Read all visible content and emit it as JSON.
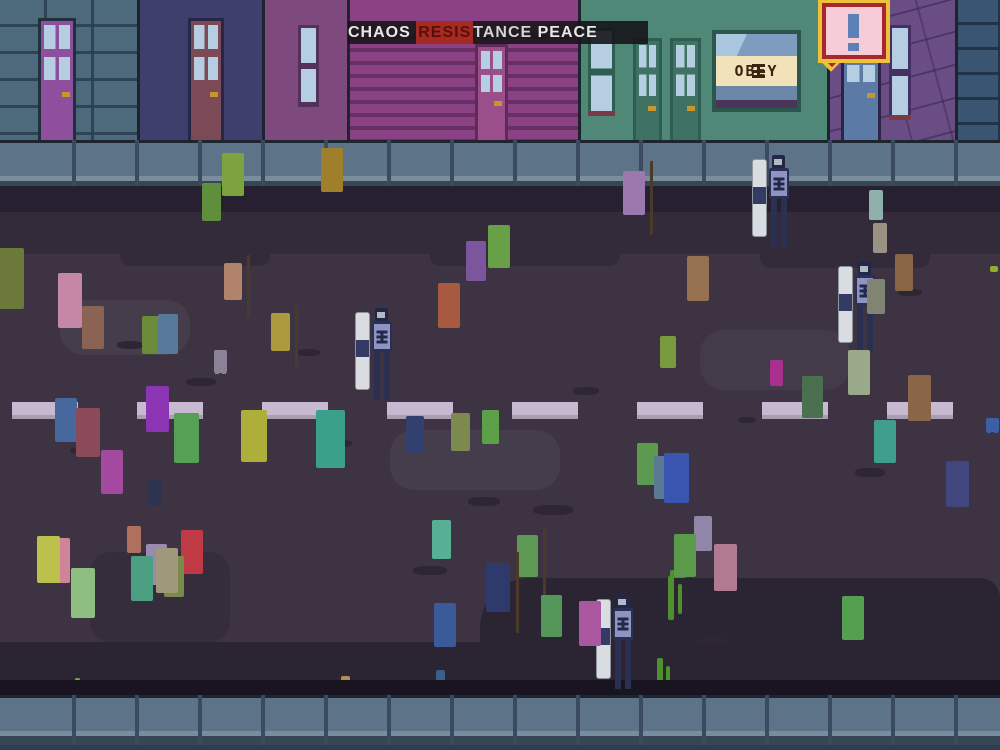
{
  "hud": {
    "meter": {
      "left_label": "CHAOS",
      "center_highlight": "RESIS",
      "center_rest": "TANCE",
      "right_label": "PEACE",
      "highlight_color": "#a62a22",
      "bar_color": "rgba(23,22,26,0.9)"
    }
  },
  "signs": {
    "obey_sign": {
      "text": "OBEY",
      "emblem": "king-emblem",
      "band_color": "#f2e2bb",
      "text_color": "#3a2410"
    },
    "alert_bubble": {
      "icon": "exclamation-icon",
      "fill": "#f6ccd6",
      "border_inner": "#a8262e",
      "border_outer": "#ecc23c",
      "glyph_color": "#5d80b6"
    }
  },
  "palette": {
    "road": "#3d3343",
    "curb_top": "#262031",
    "curb_bottom": "#191520",
    "base_strip": "#2c3e51",
    "sidewalk": "#5d7488",
    "mark": "#2e2634"
  },
  "scene": {
    "buildings": [
      {
        "x": 0,
        "w": 137,
        "wall": "#4d6a7d",
        "pattern": "brick-blue",
        "doors": [
          {
            "x": 38,
            "y": 18,
            "w": 38,
            "color": "#8e509c",
            "frame": "#22303e",
            "paneH": 46,
            "handle": true
          }
        ]
      },
      {
        "x": 137,
        "w": 125,
        "wall": "#3f3f6e",
        "sep": true,
        "doors": [
          {
            "x": 48,
            "y": 18,
            "w": 36,
            "color": "#7c4a56",
            "frame": "#262647",
            "paneH": 46,
            "handle": true
          }
        ]
      },
      {
        "x": 262,
        "w": 85,
        "wall": "#7e4a7e",
        "sep": true,
        "windows": [
          {
            "x": 33,
            "y": 25,
            "w": 21,
            "h": 82,
            "frame": "#54315a",
            "sill": "#54315a",
            "divider": true
          }
        ]
      },
      {
        "x": 347,
        "w": 231,
        "wall": "#8a4285",
        "pattern": "siding",
        "sep": true,
        "doors": [
          {
            "x": 125,
            "y": 44,
            "w": 33,
            "color": "#9a4f8b",
            "frame": "#5e2a5a",
            "paneH": 44,
            "handle": true
          }
        ]
      },
      {
        "x": 578,
        "w": 249,
        "wall": "#4f8877",
        "sep": true,
        "windows": [
          {
            "x": 7,
            "y": 28,
            "w": 27,
            "h": 88,
            "frame": "#2f5d52",
            "sill": "#7a3a45",
            "divider": true
          }
        ],
        "doors": [
          {
            "x": 52,
            "y": 38,
            "w": 29,
            "color": "#3f7263",
            "frame": "#2f5d52",
            "paneH": 52,
            "handle": true
          },
          {
            "x": 89,
            "y": 38,
            "w": 31,
            "color": "#3f7263",
            "frame": "#2f5d52",
            "paneH": 52,
            "handle": true
          }
        ]
      },
      {
        "x": 827,
        "w": 128,
        "wall": "#6b4d86",
        "pattern": "stone",
        "sep": true,
        "doors": [
          {
            "x": 11,
            "y": 34,
            "w": 40,
            "color": "#5b7aa6",
            "frame": "#2c2347",
            "paneH": 40,
            "handle": true
          }
        ],
        "windows": [
          {
            "x": 59,
            "y": 25,
            "w": 22,
            "h": 95,
            "frame": "#453064",
            "sill": "#7a3a45",
            "divider": true
          }
        ]
      },
      {
        "x": 955,
        "w": 45,
        "wall": "#3a5571",
        "pattern": "brick-dark",
        "sep": true
      }
    ],
    "crosswalk": {
      "y": 402,
      "height": 17,
      "dash_width": 66,
      "color": "#c8b9d2",
      "positions": [
        12,
        137,
        262,
        387,
        512,
        637,
        762,
        887
      ]
    },
    "blotches": [
      {
        "x": 0,
        "y": 212,
        "w": 1000,
        "h": 42,
        "c": "#342b3a",
        "r": "0"
      },
      {
        "x": 120,
        "y": 248,
        "w": 150,
        "h": 18,
        "c": "#342b3a",
        "r": "0 0 10px 10px"
      },
      {
        "x": 430,
        "y": 250,
        "w": 190,
        "h": 16,
        "c": "#342b3a",
        "r": "0 0 10px 10px"
      },
      {
        "x": 760,
        "y": 248,
        "w": 170,
        "h": 20,
        "c": "#342b3a",
        "r": "0 0 10px 10px"
      },
      {
        "x": 0,
        "y": 642,
        "w": 1000,
        "h": 40,
        "c": "#2b2433",
        "r": "0"
      },
      {
        "x": 480,
        "y": 578,
        "w": 520,
        "h": 70,
        "c": "#2b2433",
        "r": "50px 20px 0 0"
      },
      {
        "x": 0,
        "y": 654,
        "w": 260,
        "h": 30,
        "c": "#2b2433",
        "r": "14px 14px 0 0"
      },
      {
        "x": 90,
        "y": 552,
        "w": 140,
        "h": 90,
        "c": "rgba(0,0,0,0.10)",
        "r": "20px"
      },
      {
        "x": 60,
        "y": 300,
        "w": 130,
        "h": 55,
        "c": "rgba(255,255,255,0.05)",
        "r": "24px"
      },
      {
        "x": 390,
        "y": 430,
        "w": 170,
        "h": 60,
        "c": "rgba(255,255,255,0.05)",
        "r": "24px"
      },
      {
        "x": 700,
        "y": 330,
        "w": 150,
        "h": 60,
        "c": "rgba(255,255,255,0.04)",
        "r": "24px"
      }
    ],
    "marks": [
      {
        "x": 117,
        "y": 341,
        "w": 26,
        "h": 8
      },
      {
        "x": 296,
        "y": 349,
        "w": 24,
        "h": 7
      },
      {
        "x": 468,
        "y": 497,
        "w": 32,
        "h": 9
      },
      {
        "x": 533,
        "y": 505,
        "w": 40,
        "h": 10
      },
      {
        "x": 186,
        "y": 378,
        "w": 30,
        "h": 8
      },
      {
        "x": 855,
        "y": 468,
        "w": 30,
        "h": 9
      },
      {
        "x": 738,
        "y": 417,
        "w": 18,
        "h": 6
      },
      {
        "x": 898,
        "y": 289,
        "w": 24,
        "h": 7
      },
      {
        "x": 573,
        "y": 387,
        "w": 26,
        "h": 8
      },
      {
        "x": 413,
        "y": 566,
        "w": 34,
        "h": 9
      },
      {
        "x": 70,
        "y": 447,
        "w": 22,
        "h": 7
      },
      {
        "x": 698,
        "y": 638,
        "w": 30,
        "h": 8
      },
      {
        "x": 640,
        "y": 160,
        "w": 20,
        "h": 6
      },
      {
        "x": 330,
        "y": 440,
        "w": 22,
        "h": 7
      }
    ],
    "splatters": [
      {
        "x": 668,
        "y": 576,
        "w": 6,
        "h": 44,
        "c": "#4e8f2e"
      },
      {
        "x": 678,
        "y": 584,
        "w": 4,
        "h": 30,
        "c": "#4e8f2e"
      },
      {
        "x": 670,
        "y": 570,
        "w": 16,
        "h": 8,
        "c": "#4e8f2e"
      },
      {
        "x": 657,
        "y": 658,
        "w": 6,
        "h": 44,
        "c": "#4e8f2e"
      },
      {
        "x": 666,
        "y": 666,
        "w": 4,
        "h": 26,
        "c": "#4e8f2e"
      },
      {
        "x": 990,
        "y": 266,
        "w": 8,
        "h": 6,
        "c": "#8faf2e"
      },
      {
        "x": 228,
        "y": 134,
        "w": 7,
        "h": 7,
        "c": "#6fae3c"
      },
      {
        "x": 344,
        "y": 131,
        "w": 9,
        "h": 6,
        "c": "#c9962e"
      },
      {
        "x": 75,
        "y": 678,
        "w": 5,
        "h": 12,
        "c": "#6fae3c"
      },
      {
        "x": 341,
        "y": 676,
        "w": 9,
        "h": 14,
        "c": "#b08d55"
      },
      {
        "x": 436,
        "y": 670,
        "w": 9,
        "h": 26,
        "c": "#3a5f8a"
      }
    ],
    "people": [
      {
        "x": 222,
        "y": 155,
        "h": 95,
        "c": "#7da33f"
      },
      {
        "x": 202,
        "y": 185,
        "h": 85,
        "c": "#5f8f3c"
      },
      {
        "x": 321,
        "y": 150,
        "h": 98,
        "c": "#a07f2c"
      },
      {
        "x": 438,
        "y": 285,
        "h": 100,
        "c": "#a85a40"
      },
      {
        "x": 466,
        "y": 243,
        "h": 88,
        "c": "#7b569c"
      },
      {
        "x": 488,
        "y": 227,
        "h": 95,
        "c": "#68a047"
      },
      {
        "x": 623,
        "y": 173,
        "h": 98,
        "c": "#9b79ae",
        "stick": true
      },
      {
        "x": 687,
        "y": 258,
        "h": 100,
        "c": "#96714f"
      },
      {
        "x": 660,
        "y": 338,
        "h": 70,
        "c": "#7a9a3f"
      },
      {
        "x": 58,
        "y": 275,
        "h": 122,
        "c": "#c587a6",
        "w": 30
      },
      {
        "x": 82,
        "y": 308,
        "h": 95,
        "c": "#8a6355"
      },
      {
        "x": -6,
        "y": 250,
        "h": 135,
        "c": "#6b7a3a"
      },
      {
        "x": 142,
        "y": 318,
        "h": 85,
        "c": "#6b8a3a"
      },
      {
        "x": 158,
        "y": 316,
        "h": 88,
        "c": "#58799a"
      },
      {
        "x": 224,
        "y": 265,
        "h": 82,
        "c": "#b0836a",
        "stick": true
      },
      {
        "x": 214,
        "y": 352,
        "h": 52,
        "c": "#8b8298"
      },
      {
        "x": 271,
        "y": 315,
        "h": 85,
        "c": "#ad9a3c",
        "stick": true
      },
      {
        "x": 869,
        "y": 192,
        "h": 66,
        "c": "#8fb0ab"
      },
      {
        "x": 873,
        "y": 225,
        "h": 66,
        "c": "#9a9283"
      },
      {
        "x": 895,
        "y": 256,
        "h": 82,
        "c": "#8a6544"
      },
      {
        "x": 867,
        "y": 281,
        "h": 78,
        "c": "#7f8572"
      },
      {
        "x": 770,
        "y": 362,
        "h": 58,
        "c": "#a8308f"
      },
      {
        "x": 848,
        "y": 352,
        "h": 100,
        "c": "#9aa98a"
      },
      {
        "x": 874,
        "y": 422,
        "h": 96,
        "c": "#3f9e8c"
      },
      {
        "x": 908,
        "y": 377,
        "h": 103,
        "c": "#8a6548"
      },
      {
        "x": 802,
        "y": 378,
        "h": 94,
        "c": "#4a7050"
      },
      {
        "x": 55,
        "y": 400,
        "h": 98,
        "c": "#47689c"
      },
      {
        "x": 76,
        "y": 410,
        "h": 108,
        "c": "#8a4a5a"
      },
      {
        "x": 101,
        "y": 452,
        "h": 98,
        "c": "#a34aa0"
      },
      {
        "x": 146,
        "y": 388,
        "h": 103,
        "c": "#8b35b5"
      },
      {
        "x": 148,
        "y": 482,
        "h": 58,
        "c": "#2e3450"
      },
      {
        "x": 174,
        "y": 415,
        "h": 112,
        "c": "#55a055"
      },
      {
        "x": 241,
        "y": 412,
        "h": 115,
        "c": "#aeae3a"
      },
      {
        "x": 316,
        "y": 412,
        "h": 128,
        "c": "#3aa08a",
        "w": 36
      },
      {
        "x": 37,
        "y": 538,
        "h": 105,
        "c": "#bcc14b"
      },
      {
        "x": 48,
        "y": 540,
        "h": 100,
        "c": "#d0849a"
      },
      {
        "x": 71,
        "y": 570,
        "h": 112,
        "c": "#8fbf80",
        "w": 30
      },
      {
        "x": 127,
        "y": 528,
        "h": 60,
        "c": "#b07060"
      },
      {
        "x": 131,
        "y": 558,
        "h": 100,
        "c": "#4aa080"
      },
      {
        "x": 146,
        "y": 546,
        "h": 92,
        "c": "#9a8ab0"
      },
      {
        "x": 156,
        "y": 550,
        "h": 100,
        "c": "#a0987a"
      },
      {
        "x": 164,
        "y": 558,
        "h": 90,
        "c": "#7a8a4a"
      },
      {
        "x": 181,
        "y": 532,
        "h": 98,
        "c": "#c03a45"
      },
      {
        "x": 406,
        "y": 418,
        "h": 82,
        "c": "#31406e"
      },
      {
        "x": 451,
        "y": 415,
        "h": 85,
        "c": "#7c8a50"
      },
      {
        "x": 482,
        "y": 412,
        "h": 76,
        "c": "#5da04a"
      },
      {
        "x": 432,
        "y": 522,
        "h": 86,
        "c": "#57b093"
      },
      {
        "x": 434,
        "y": 605,
        "h": 98,
        "c": "#3a5a9a"
      },
      {
        "x": 486,
        "y": 565,
        "h": 108,
        "c": "#2e3a6b",
        "head": "#c8b37a",
        "stick": true
      },
      {
        "x": 517,
        "y": 537,
        "h": 94,
        "c": "#5e9a55",
        "stick": true
      },
      {
        "x": 541,
        "y": 597,
        "h": 94,
        "c": "#55975a"
      },
      {
        "x": 579,
        "y": 603,
        "h": 100,
        "c": "#a857a0"
      },
      {
        "x": 637,
        "y": 445,
        "h": 93,
        "c": "#5c9a50"
      },
      {
        "x": 654,
        "y": 458,
        "h": 96,
        "c": "#5a7a94"
      },
      {
        "x": 659,
        "y": 460,
        "h": 78,
        "c": "#8a6a3a"
      },
      {
        "x": 664,
        "y": 455,
        "h": 110,
        "c": "#3a55b0"
      },
      {
        "x": 674,
        "y": 536,
        "h": 96,
        "c": "#5a9a4a"
      },
      {
        "x": 694,
        "y": 518,
        "h": 78,
        "c": "#8f86a8"
      },
      {
        "x": 714,
        "y": 546,
        "h": 104,
        "c": "#b07a90"
      },
      {
        "x": 946,
        "y": 463,
        "h": 103,
        "c": "#41467e"
      },
      {
        "x": 842,
        "y": 598,
        "h": 98,
        "c": "#55a050"
      },
      {
        "x": 986,
        "y": 420,
        "h": 30,
        "c": "#3d5fa6"
      }
    ],
    "police": [
      {
        "x": 752,
        "y": 155,
        "h": 92
      },
      {
        "x": 838,
        "y": 262,
        "h": 90
      },
      {
        "x": 355,
        "y": 308,
        "h": 92
      },
      {
        "x": 596,
        "y": 595,
        "h": 94
      }
    ]
  }
}
